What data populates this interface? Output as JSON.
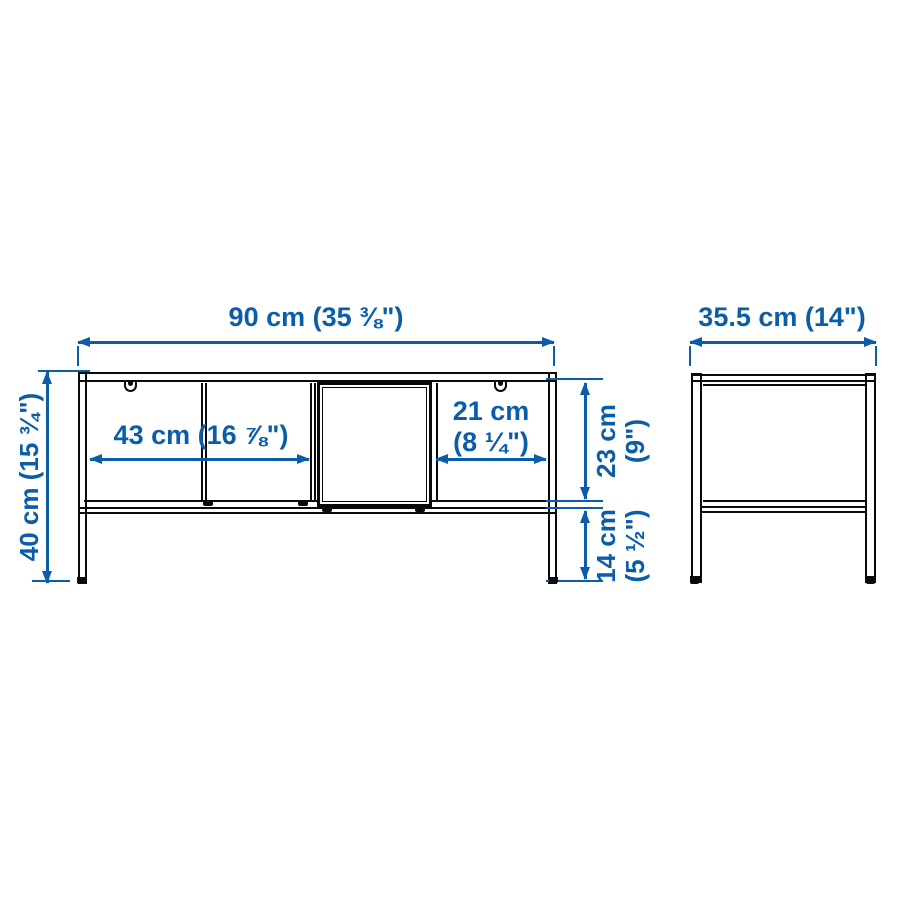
{
  "colors": {
    "dimension_blue": "#0b5da8",
    "drawing_black": "#0a0a0a",
    "background": "#ffffff"
  },
  "dimensions": {
    "overall_width": {
      "label": "90 cm (35 ⅜\")"
    },
    "depth": {
      "label": "35.5 cm (14\")"
    },
    "overall_height": {
      "label": "40 cm (15 ¾\")"
    },
    "shelf_width": {
      "label": "43 cm (16 ⅞\")"
    },
    "right_compartment_width": {
      "line1": "21 cm",
      "line2": "(8 ¼\")"
    },
    "compartment_height": {
      "line1": "23 cm",
      "line2": "(9\")"
    },
    "leg_clearance": {
      "line1": "14 cm",
      "line2": "(5 ½\")"
    }
  }
}
